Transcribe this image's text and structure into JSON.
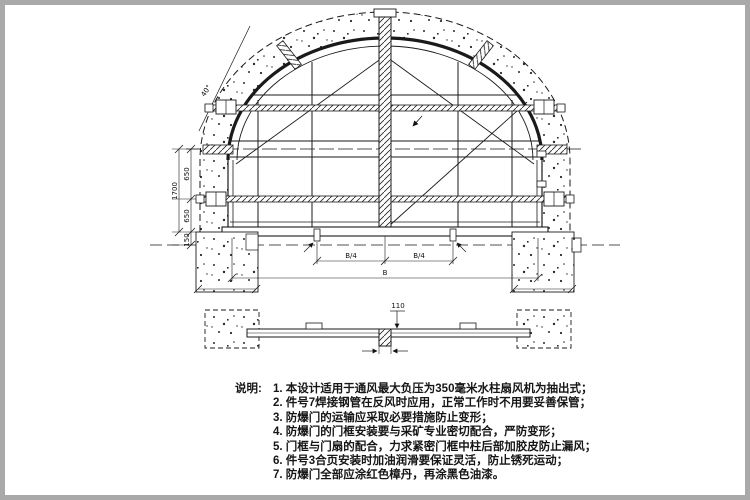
{
  "drawing": {
    "views": {
      "front": "front-elevation-of-explosion-proof-door",
      "section": "horizontal-section-view"
    }
  },
  "dimensions": {
    "left_upper": "650",
    "left_lower": "650",
    "left_total": "1700",
    "left_floor": "150",
    "bottom_left_quarter": "B/4",
    "bottom_right_quarter": "B/4",
    "bottom_total": "B",
    "arc_angle": "40°",
    "section_height": "110"
  },
  "notes": {
    "label": "说明:",
    "items": [
      "1. 本设计适用于通风最大负压为350毫米水柱扇风机为抽出式；",
      "2. 件号7焊接钢管在反风时应用，正常工作时不用要妥善保管；",
      "3. 防爆门的运输应采取必要措施防止变形；",
      "4. 防爆门的门框安装要与采矿专业密切配合，严防变形；",
      "5. 门框与门扇的配合，力求紧密门框中柱后部加胶皮防止漏风；",
      "6. 件号3合页安装时加油润滑要保证灵活，防止锈死运动；",
      "7. 防爆门全部应涂红色樟丹，再涂黑色油漆。"
    ]
  },
  "colors": {
    "line": "#1a1a1a",
    "frame_border": "#a9a9a9",
    "paper": "#ffffff"
  }
}
